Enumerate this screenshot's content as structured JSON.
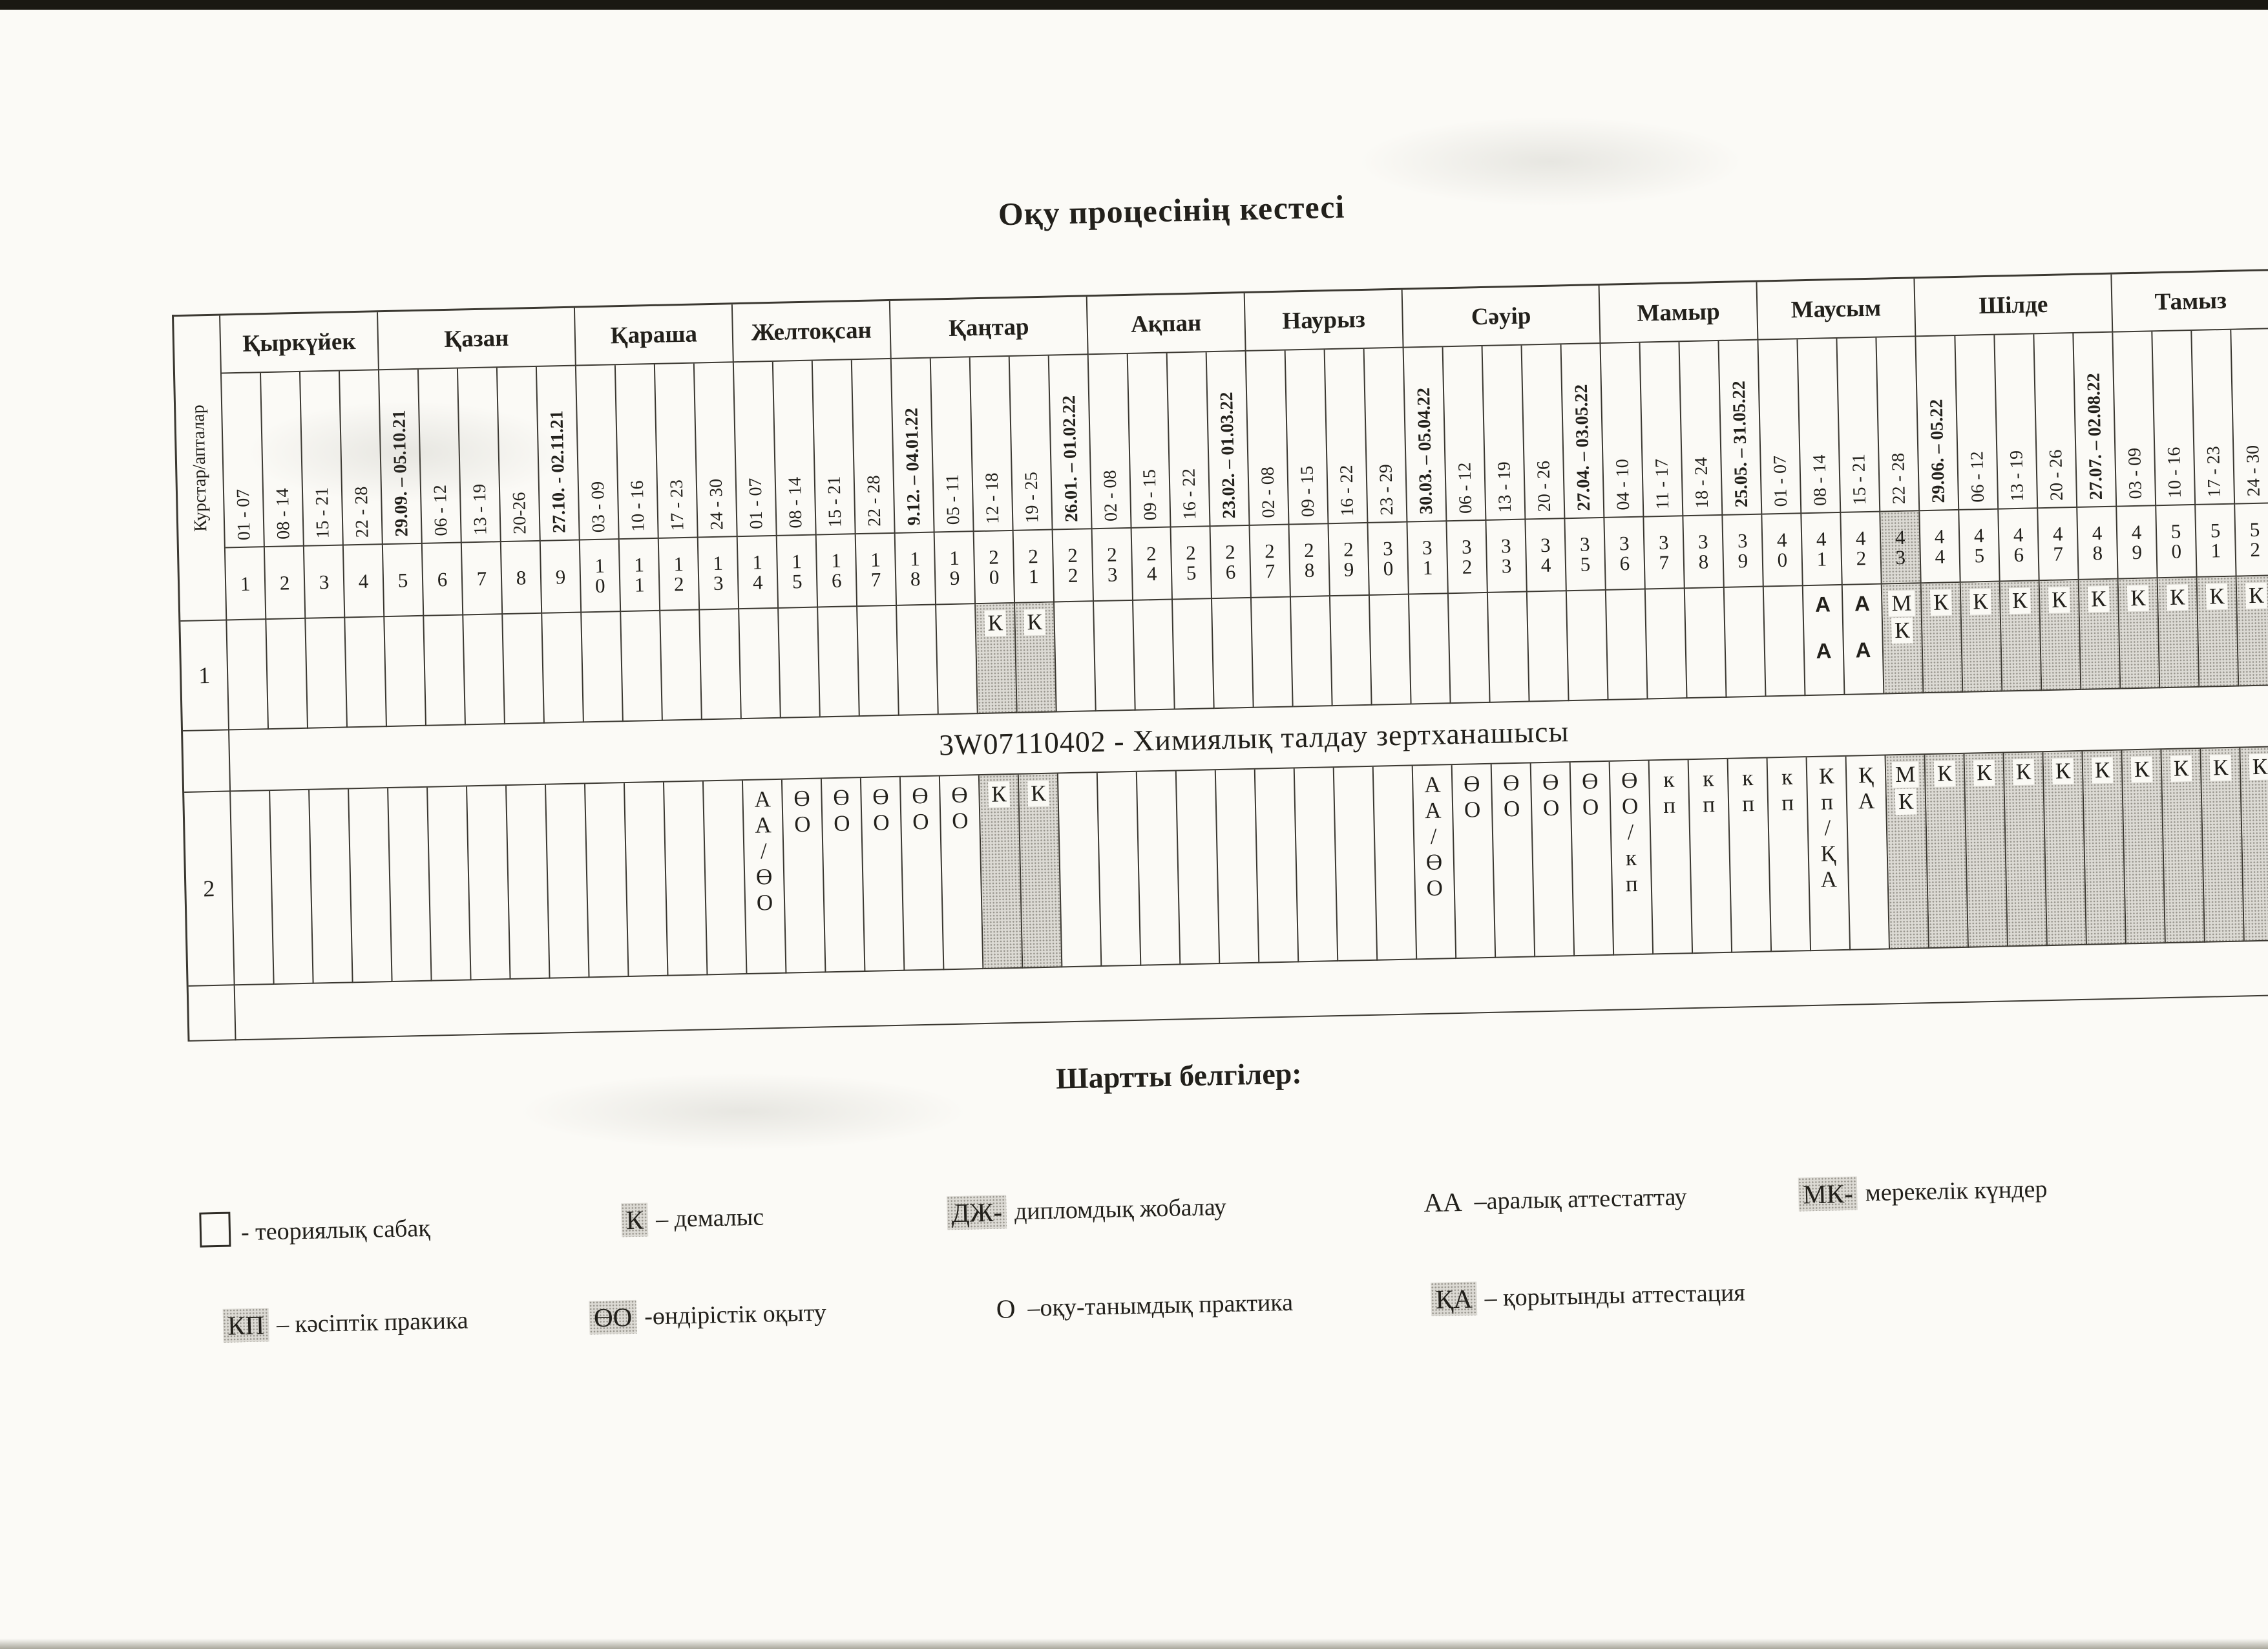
{
  "page": {
    "title": "Оқу процесінің кестесі",
    "corner_label": "Курстар/апталар",
    "qualification": "3W07110402 - Химиялық талдау зертханашысы"
  },
  "calendar": {
    "months": [
      {
        "name": "Қыркүйек",
        "weeks": 4
      },
      {
        "name": "Қазан",
        "weeks": 5
      },
      {
        "name": "Қараша",
        "weeks": 4
      },
      {
        "name": "Желтоқсан",
        "weeks": 4
      },
      {
        "name": "Қаңтар",
        "weeks": 5
      },
      {
        "name": "Ақпан",
        "weeks": 4
      },
      {
        "name": "Наурыз",
        "weeks": 4
      },
      {
        "name": "Сәуір",
        "weeks": 5
      },
      {
        "name": "Мамыр",
        "weeks": 4
      },
      {
        "name": "Маусым",
        "weeks": 4
      },
      {
        "name": "Шілде",
        "weeks": 5
      },
      {
        "name": "Тамыз",
        "weeks": 4
      }
    ],
    "weeks": [
      {
        "num": "1",
        "dates": "01 - 07"
      },
      {
        "num": "2",
        "dates": "08 - 14"
      },
      {
        "num": "3",
        "dates": "15 - 21"
      },
      {
        "num": "4",
        "dates": "22 - 28"
      },
      {
        "num": "5",
        "dates": "29.09. – 05.10.21",
        "bold": true
      },
      {
        "num": "6",
        "dates": "06 - 12"
      },
      {
        "num": "7",
        "dates": "13 - 19"
      },
      {
        "num": "8",
        "dates": "20-26"
      },
      {
        "num": "9",
        "dates": "27.10. - 02.11.21",
        "bold": true
      },
      {
        "num": "10",
        "dates": "03 - 09"
      },
      {
        "num": "11",
        "dates": "10 - 16"
      },
      {
        "num": "12",
        "dates": "17 - 23"
      },
      {
        "num": "13",
        "dates": "24 - 30"
      },
      {
        "num": "14",
        "dates": "01 - 07"
      },
      {
        "num": "15",
        "dates": "08 - 14"
      },
      {
        "num": "16",
        "dates": "15 - 21"
      },
      {
        "num": "17",
        "dates": "22 - 28"
      },
      {
        "num": "18",
        "dates": "9.12. – 04.01.22",
        "bold": true
      },
      {
        "num": "19",
        "dates": "05 - 11"
      },
      {
        "num": "20",
        "dates": "12 - 18"
      },
      {
        "num": "21",
        "dates": "19 - 25"
      },
      {
        "num": "22",
        "dates": "26.01. – 01.02.22",
        "bold": true
      },
      {
        "num": "23",
        "dates": "02 - 08"
      },
      {
        "num": "24",
        "dates": "09 - 15"
      },
      {
        "num": "25",
        "dates": "16 - 22"
      },
      {
        "num": "26",
        "dates": "23.02. – 01.03.22",
        "bold": true
      },
      {
        "num": "27",
        "dates": "02 - 08"
      },
      {
        "num": "28",
        "dates": "09 - 15"
      },
      {
        "num": "29",
        "dates": "16 - 22"
      },
      {
        "num": "30",
        "dates": "23 - 29"
      },
      {
        "num": "31",
        "dates": "30.03. – 05.04.22",
        "bold": true
      },
      {
        "num": "32",
        "dates": "06 - 12"
      },
      {
        "num": "33",
        "dates": "13 - 19"
      },
      {
        "num": "34",
        "dates": "20 - 26"
      },
      {
        "num": "35",
        "dates": "27.04. – 03.05.22",
        "bold": true
      },
      {
        "num": "36",
        "dates": "04 - 10"
      },
      {
        "num": "37",
        "dates": "11 - 17"
      },
      {
        "num": "38",
        "dates": "18 - 24"
      },
      {
        "num": "39",
        "dates": "25.05. – 31.05.22",
        "bold": true
      },
      {
        "num": "40",
        "dates": "01 - 07"
      },
      {
        "num": "41",
        "dates": "08 - 14"
      },
      {
        "num": "42",
        "dates": "15 - 21"
      },
      {
        "num": "43",
        "dates": "22 - 28"
      },
      {
        "num": "44",
        "dates": "29.06. – 05.22",
        "bold": true
      },
      {
        "num": "45",
        "dates": "06 - 12"
      },
      {
        "num": "46",
        "dates": "13 - 19"
      },
      {
        "num": "47",
        "dates": "20 - 26"
      },
      {
        "num": "48",
        "dates": "27.07. – 02.08.22",
        "bold": true
      },
      {
        "num": "49",
        "dates": "03 - 09"
      },
      {
        "num": "50",
        "dates": "10 - 16"
      },
      {
        "num": "51",
        "dates": "17 - 23"
      },
      {
        "num": "52",
        "dates": "24 - 30"
      }
    ],
    "shaded_week_number_cells": [
      43
    ]
  },
  "courses": [
    {
      "label": "1",
      "cells": [
        {
          "weeks": [
            20,
            21
          ],
          "text": "К",
          "shaded": true
        },
        {
          "weeks": [
            41,
            42
          ],
          "text": "АА",
          "bold": true
        },
        {
          "weeks": [
            43
          ],
          "text": "МК",
          "shaded": true
        },
        {
          "weeks": [
            44,
            45,
            46,
            47,
            48,
            49,
            50,
            51,
            52
          ],
          "text": "К",
          "shaded": true
        }
      ]
    },
    {
      "label": "2",
      "cells": [
        {
          "weeks": [
            14
          ],
          "text": "АА/ӨО"
        },
        {
          "weeks": [
            15,
            16,
            17,
            18,
            19
          ],
          "text": "ӨО"
        },
        {
          "weeks": [
            20,
            21
          ],
          "text": "К",
          "shaded": true
        },
        {
          "weeks": [
            31
          ],
          "text": "АА/ӨО"
        },
        {
          "weeks": [
            32,
            33,
            34,
            35
          ],
          "text": "ӨО"
        },
        {
          "weeks": [
            36
          ],
          "text": "ӨО/кп"
        },
        {
          "weeks": [
            37,
            38,
            39,
            40
          ],
          "text": "кп"
        },
        {
          "weeks": [
            41
          ],
          "text": "Кп/ҚА"
        },
        {
          "weeks": [
            42
          ],
          "text": "ҚА"
        },
        {
          "weeks": [
            43
          ],
          "text": "МК",
          "shaded": true
        },
        {
          "weeks": [
            44,
            45,
            46,
            47,
            48,
            49,
            50,
            51,
            52
          ],
          "text": "К",
          "shaded": true
        }
      ]
    }
  ],
  "legend": {
    "title": "Шартты белгілер:",
    "rows": [
      [
        {
          "symbol": "",
          "box": true,
          "text": "- теориялық сабақ"
        },
        {
          "symbol": "К",
          "shaded": true,
          "text": "– демалыс"
        },
        {
          "symbol": "ДЖ-",
          "shaded": true,
          "text": "дипломдық жобалау"
        },
        {
          "symbol": "АА",
          "shaded": false,
          "text": "–аралық аттестаттау"
        },
        {
          "symbol": "МК-",
          "shaded": true,
          "text": "мерекелік күндер"
        }
      ],
      [
        {
          "symbol": "КП",
          "shaded": true,
          "text": "– кәсіптік пракика"
        },
        {
          "symbol": "ӨО",
          "shaded": true,
          "text": "-өндірістік оқыту"
        },
        {
          "symbol": "О",
          "shaded": false,
          "text": "–оқу-танымдық практика"
        },
        {
          "symbol": "ҚА",
          "shaded": true,
          "text": "– қорытынды аттестация"
        }
      ]
    ]
  },
  "colors": {
    "paper": "#fbfaf6",
    "ink": "#22201b",
    "grid_line": "#3b3831",
    "shade_fill": "#dcdad4",
    "shade_dot": "#97948c"
  }
}
